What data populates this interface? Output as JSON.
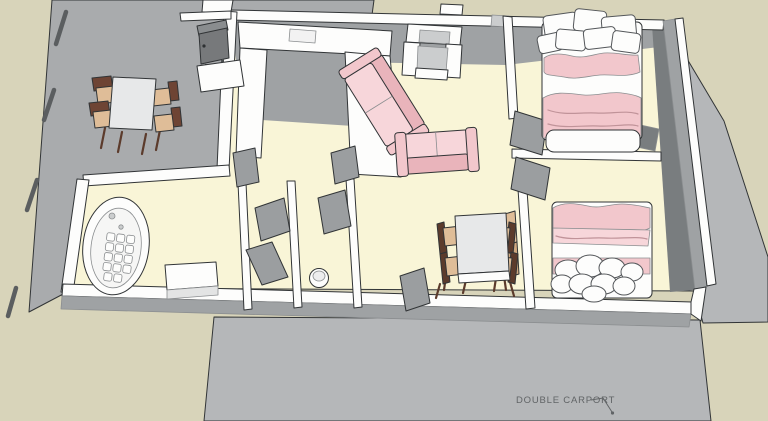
{
  "annotation": {
    "carport_label": "DOUBLE CARPORT"
  },
  "palette": {
    "ground_beige": "#d8d4ba",
    "deck_gray": "#a9abad",
    "carport_gray": "#b5b7b9",
    "floor_cream": "#f9f5d7",
    "wall_white": "#fdfdfc",
    "wall_gray": "#9fa2a4",
    "wall_gray_dark": "#797d7f",
    "wall_gray_light": "#cbcdce",
    "door_gray": "#9b9ea0",
    "sofa_pink": "#f2c7cc",
    "sofa_pink_dark": "#e9b4bb",
    "sofa_pink_light": "#f7d6da",
    "blanket_line": "#c09399",
    "chair_tan": "#dfbd98",
    "wood_dark": "#5c3b2c",
    "appliance_gray": "#77797b",
    "table_top": "#e7e8e9",
    "outline": "#313436",
    "outline_soft": "#8b8e90",
    "label_gray": "#616466"
  },
  "furniture": [
    "outdoor-dining-set",
    "bbq-grill",
    "kitchen-counter",
    "armchair",
    "sofa",
    "loveseat",
    "double-bed",
    "double-bed",
    "dresser",
    "bathtub",
    "vanity",
    "toilet",
    "dining-table-set",
    "fence-posts"
  ]
}
